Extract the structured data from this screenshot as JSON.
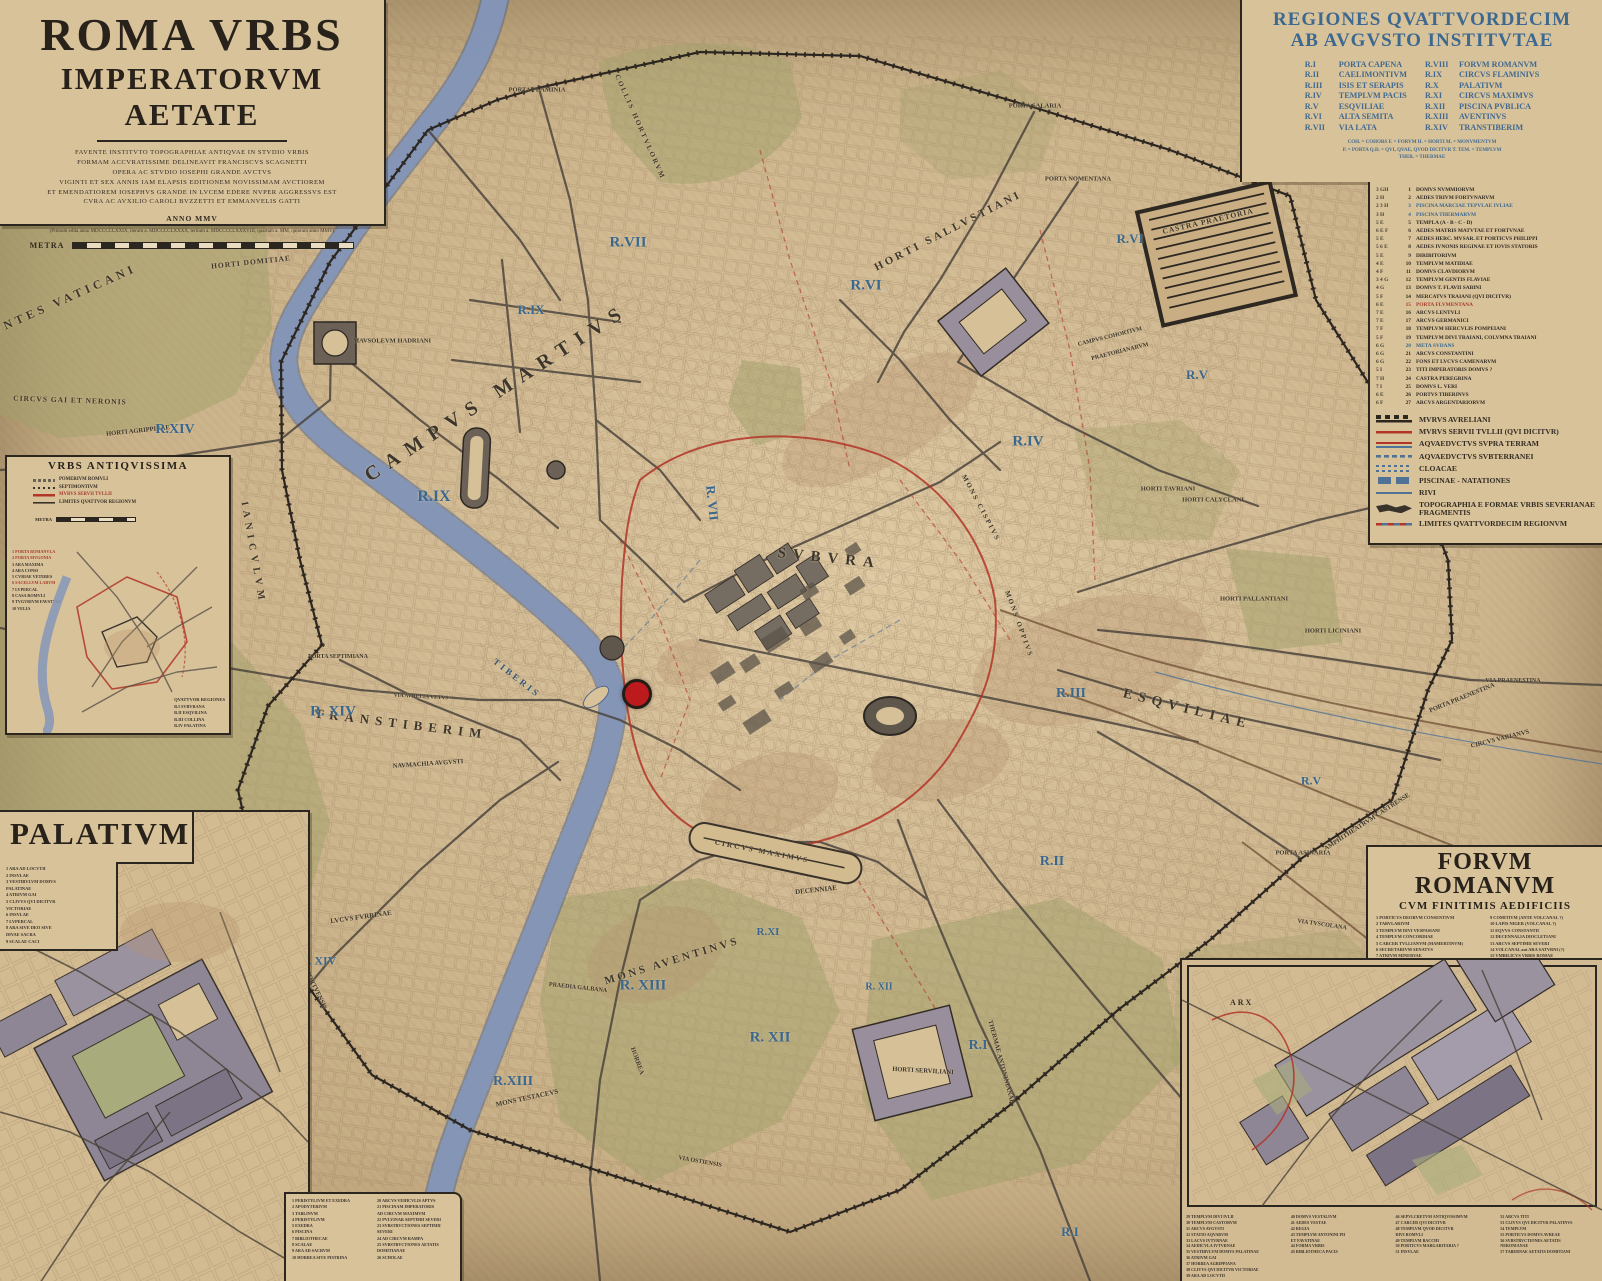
{
  "colors": {
    "parchment": "#d4bc93",
    "river": "#8496b8",
    "wall": "#2c2620",
    "servian_wall": "#b23527",
    "region_label_blue": "#3a678f",
    "legend_blue": "#416990",
    "green": "#a2a06a",
    "road": "#48413a",
    "aqueduct_brown": "#7a5b3f",
    "water_line": "#4f7296",
    "marker_red": "#bd1a1d"
  },
  "title_box": {
    "title1": "ROMA VRBS",
    "title2": "IMPERATORVM AETATE",
    "credits": [
      "FAVENTE INSTITVTO TOPOGRAPHIAE ANTIQVAE IN STVDIO VRBIS",
      "FORMAM ACCVRATISSIME DELINEAVIT FRANCISCVS SCAGNETTI",
      "OPERA AC STVDIO IOSEPHI GRANDE AVCTVS",
      "VIGINTI ET SEX ANNIS IAM ELAPSIS EDITIONEM NOVISSIMAM AVCTIOREM",
      "ET EMENDATIOREM IOSEPHVS GRANDE IN LVCEM EDERE NVPER AGGRESSVS EST",
      "CVRA AC AVXILIO CAROLI BVZZETTI ET EMMANVELIS GATTI"
    ],
    "anno": "ANNO MMV",
    "editions": "(Primum edita anno MDCCCCLXXIX, iterum a. MDCCCCLXXXX, tertium a. MDCCCCLXXXVIII, quartum a. MM, quintum anno MMV)",
    "scale_label": "METRA"
  },
  "regiones": {
    "title1": "REGIONES QVATTVORDECIM",
    "title2": "AB AVGVSTO INSTITVTAE",
    "left": [
      {
        "code": "R.I",
        "name": "PORTA CAPENA"
      },
      {
        "code": "R.II",
        "name": "CAELIMONTIVM"
      },
      {
        "code": "R.III",
        "name": "ISIS ET SERAPIS"
      },
      {
        "code": "R.IV",
        "name": "TEMPLVM PACIS"
      },
      {
        "code": "R.V",
        "name": "ESQVILIAE"
      },
      {
        "code": "R.VI",
        "name": "ALTA SEMITA"
      },
      {
        "code": "R.VII",
        "name": "VIA LATA"
      }
    ],
    "right": [
      {
        "code": "R.VIII",
        "name": "FORVM ROMANVM"
      },
      {
        "code": "R.IX",
        "name": "CIRCVS FLAMINIVS"
      },
      {
        "code": "R.X",
        "name": "PALATIVM"
      },
      {
        "code": "R.XI",
        "name": "CIRCVS MAXIMVS"
      },
      {
        "code": "R.XII",
        "name": "PISCINA PVBLICA"
      },
      {
        "code": "R.XIII",
        "name": "AVENTINVS"
      },
      {
        "code": "R.XIV",
        "name": "TRANSTIBERIM"
      }
    ],
    "abbreviations": [
      "COH. = COHORS      F. = FORVM      H. = HORTI      M. = MONVMENTVM",
      "P. = PORTA      Q.D. = QVI, QVAE, QVOD DICITVR      T. TEM. = TEMPLVM",
      "THER. = THERMAE"
    ]
  },
  "index": {
    "entries": [
      {
        "g": "3 GH",
        "n": "1",
        "t": "DOMVS NVMMIORVM"
      },
      {
        "g": "2 H",
        "n": "2",
        "t": "AEDES TRIVM FORTVNARVM"
      },
      {
        "g": "2 3 H",
        "n": "3",
        "t": "PISCINA MARCIAE TEPVLAE IVLIAE",
        "c": "blue"
      },
      {
        "g": "3 H",
        "n": "4",
        "t": "PISCINA THERMARVM",
        "c": "blue"
      },
      {
        "g": "5 E",
        "n": "5",
        "t": "TEMPLA  (A - B - C - D)"
      },
      {
        "g": "6 E F",
        "n": "6",
        "t": "AEDES MATRIS MATVTAE ET FORTVNAE"
      },
      {
        "g": "5 E",
        "n": "7",
        "t": "AEDES HERC. MVSAR. ET PORTICVS PHILIPPI"
      },
      {
        "g": "5 6 E",
        "n": "8",
        "t": "AEDES IVNONIS REGINAE ET IOVIS STATORIS"
      },
      {
        "g": "5 E",
        "n": "9",
        "t": "DIRIBITORIVM"
      },
      {
        "g": "4 E",
        "n": "10",
        "t": "TEMPLVM MATIDIAE"
      },
      {
        "g": "4 F",
        "n": "11",
        "t": "DOMVS CLAVDIORVM"
      },
      {
        "g": "3 4 G",
        "n": "12",
        "t": "TEMPLVM GENTIS FLAVIAE"
      },
      {
        "g": "4 G",
        "n": "13",
        "t": "DOMVS T. FLAVII SABINI"
      },
      {
        "g": "5 F",
        "n": "14",
        "t": "MERCATVS TRAIANI (QVI DICITVR)"
      },
      {
        "g": "6 E",
        "n": "15",
        "t": "PORTA FLVMENTANA",
        "c": "red"
      },
      {
        "g": "7 E",
        "n": "16",
        "t": "ARCVS LENTVLI"
      },
      {
        "g": "7 E",
        "n": "17",
        "t": "ARCVS GERMANICI"
      },
      {
        "g": "7 F",
        "n": "18",
        "t": "TEMPLVM HERCVLIS POMPEIANI"
      },
      {
        "g": "5 F",
        "n": "19",
        "t": "TEMPLVM DIVI TRAIANI, COLVMNA TRAIANI"
      },
      {
        "g": "6 G",
        "n": "20",
        "t": "META SVDANS",
        "c": "blue"
      },
      {
        "g": "6 G",
        "n": "21",
        "t": "ARCVS CONSTANTINI"
      },
      {
        "g": "6 G",
        "n": "22",
        "t": "FONS ET LVCVS CAMENARVM"
      },
      {
        "g": "5 I",
        "n": "23",
        "t": "TITI IMPERATORIS DOMVS ?"
      },
      {
        "g": "7 H",
        "n": "24",
        "t": "CASTRA PEREGRINA"
      },
      {
        "g": "7 I",
        "n": "25",
        "t": "DOMVS L. VERI"
      },
      {
        "g": "6 E",
        "n": "26",
        "t": "PORTVS TIBERINVS"
      },
      {
        "g": "6 F",
        "n": "27",
        "t": "ARCVS ARGENTARIORVM"
      }
    ]
  },
  "symbols": {
    "items": [
      {
        "k": "wall",
        "t": "MVRVS AVRELIANI"
      },
      {
        "k": "servian",
        "t": "MVRVS SERVII TVLLII (QVI DICITVR)"
      },
      {
        "k": "aq-supra",
        "t": "AQVAEDVCTVS SVPRA TERRAM"
      },
      {
        "k": "aq-sub",
        "t": "AQVAEDVCTVS SVBTERRANEI"
      },
      {
        "k": "cloacae",
        "t": "CLOACAE"
      },
      {
        "k": "piscinae",
        "t": "PISCINAE - NATATIONES"
      },
      {
        "k": "rivi",
        "t": "RIVI"
      },
      {
        "k": "frag",
        "t": "TOPOGRAPHIA E FORMAE VRBIS SEVERIANAE FRAGMENTIS"
      },
      {
        "k": "limites",
        "t": "LIMITES QVATTVORDECIM REGIONVM"
      }
    ]
  },
  "urbs_inset": {
    "title": "VRBS ANTIQVISSIMA",
    "legend": [
      {
        "k": "pomerium",
        "t": "POMERIVM ROMVLI"
      },
      {
        "k": "septimontium",
        "t": "SEPTIMONTIVM"
      },
      {
        "k": "servian",
        "t": "MVRVS SERVII TVLLII",
        "c": "red"
      },
      {
        "k": "limites4",
        "t": "LIMITES QVATTVOR REGIONVM"
      }
    ],
    "scale_label": "METRA",
    "sites": [
      "PORTA ROMANVLA",
      "PORTA MVGONIA",
      "ARA MAXIMA",
      "ARA CONSI",
      "CVRIAE VETERES",
      "SACELLVM LARVM",
      "LVPERCAL",
      "CASA ROMVLI",
      "TVGVRIVM FAVSTVLI",
      "VELIA"
    ],
    "sites_red": [
      0,
      1,
      5
    ],
    "regions_title": "QVATTVOR REGIONES",
    "regions": [
      "R.I   SVBVRANA",
      "R.II  ESQVILINA",
      "R.III COLLINA",
      "R.IV  PALATINA"
    ]
  },
  "palatium_inset": {
    "title": "PALATIVM",
    "list": [
      "1  ARA AD LOCVTII",
      "2  INSVLAE",
      "3  VESTIBVLVM DOMVS",
      "    PALATINAE",
      "4  ATRIVM GAI",
      "5  CLIVVS QVI DICITVR",
      "    VICTORIAE",
      "6  INSVLAE",
      "7  LVPERCAL",
      "8  ARA SIVE DEO SIVE",
      "    DIVAE SACRA",
      "9  SCALAE CACI"
    ]
  },
  "south_list": {
    "left": [
      "1  PERISTYLIVM ET EXEDRA",
      "2  APODYTERIVM",
      "3  TABLINVM",
      "4  PERISTYLIVM",
      "5  EXEDRA",
      "6  PISCINA",
      "7  BIBLIOTHECAE",
      "8  SCALAE",
      "9  ARA AD SACRVM",
      "10 HORREA SIVE PISTRINA"
    ],
    "right": [
      "20 ARCVS VEHICVLIS APTVS",
      "21 PISCINAM IMPERATORIS",
      "     AD CIRCVM MAXIMVM",
      "22 PVLVINAR SEPTIMII SEVERI",
      "23 SVBSTRVCTIONES SEPTIMII",
      "     SEVERI",
      "24 AD CIRCVM RAMPA",
      "25 SVBSTRVCTIONES AETATIS",
      "     DOMITIANAE",
      "26 SCHOLAE"
    ]
  },
  "forum_inset": {
    "title": "FORVM ROMANVM",
    "subtitle": "CVM FINITIMIS AEDIFICIIS",
    "map_label": "ARX",
    "col1": [
      "1  PORTICVS DEORVM CONSENTIVM",
      "2  TABVLARIVM",
      "3  TEMPLVM DIVI VESPASIANI",
      "4  TEMPLVM CONCORDIAE",
      "5  CARCER TVLLIANVM (MAMERTINVM)",
      "6  SECRETARIVM SENATVS",
      "7  ATRIVM MINERVAE",
      "8  CVRIA"
    ],
    "col2": [
      "9  COMITIVM (ANTE VOLCANAL ?)",
      "10 LAPIS NIGER (VOLCANAL ?)",
      "11 EQVVS CONSTANTII",
      "12 DECENNALIA DIOCLETIANI",
      "13 ARCVS SEPTIMII SEVERI",
      "14 VOLCANAL aut ARA SATVRNI (?)",
      "15 VMBILICVS VRBIS ROMAE",
      "16 ROSTRA",
      "17 MILIARIVM AVREVM",
      "18 ARCVS",
      "19 AEDES SATVRNI"
    ],
    "bottom1": [
      "29 TEMPLVM DIVI IVLII",
      "30 TEMPLVM CASTORVM",
      "31 ARCVS AVGVSTI",
      "32 STATIO AQVARVM",
      "33 LACVS IVTVRNAE",
      "34 AEDICVLA IVTVRNAE",
      "35 VESTIBVLVM DOMVS PALATINAE",
      "36 ATRIVM GAI",
      "37 HORREA AGRIPPIANA",
      "38 CLIVVS QVI DICITVR VICTORIAE",
      "39 ARA AD LOCVTII"
    ],
    "bottom2": [
      "40 DOMVS VESTALIVM",
      "41 AEDES VESTAE",
      "42 REGIA",
      "43 TEMPLVM ANTONINI PII",
      "     ET FAVSTINAE",
      "44 FORMA VRBIS",
      "45 BIBLIOTHECA PACIS"
    ],
    "bottom3": [
      "46 SEPVLCRETVM ANTIQVISSIMVM",
      "47 CARCER QVI DICITVR",
      "48 TEMPLVM QVOD DICITVR",
      "     DIVI ROMVLI",
      "49 TEMPLVM BACCHI",
      "50 PORTICVS MARGARITARIA ?",
      "51 INSVLAE"
    ],
    "bottom4": [
      "52 ARCVS TITI",
      "53 CLIVVS QVI DICITVR PALATINVS",
      "54 TEMPLVM",
      "55 PORTICVS DOMVS AVREAE",
      "56 SVBSTRVCTIONES AETATIS",
      "     NERONIANAE",
      "57 TABERNAE AETATIS DOMITIANI"
    ]
  },
  "map_labels": [
    {
      "t": "MONTES VATICANI",
      "x": 57,
      "y": 303,
      "s": 12,
      "r": -24,
      "ls": 4
    },
    {
      "t": "HORTI DOMITIAE",
      "x": 251,
      "y": 262,
      "s": 7.5,
      "r": -6,
      "ls": 1
    },
    {
      "t": "MAVSOLEVM HADRIANI",
      "x": 392,
      "y": 341,
      "s": 6.5
    },
    {
      "t": "CIRCVS GAI ET NERONIS",
      "x": 70,
      "y": 400,
      "s": 7.5,
      "r": 2,
      "ls": 1
    },
    {
      "t": "HORTI AGRIPPINAE",
      "x": 138,
      "y": 431,
      "s": 6.5,
      "r": -6
    },
    {
      "t": "CAMPVS MARTIVS",
      "x": 497,
      "y": 393,
      "s": 20,
      "r": -33,
      "ls": 9
    },
    {
      "t": "R.VII",
      "x": 628,
      "y": 243,
      "s": 15,
      "c": "blue"
    },
    {
      "t": "R.IX",
      "x": 531,
      "y": 310,
      "s": 13,
      "c": "blue"
    },
    {
      "t": "R.IX",
      "x": 434,
      "y": 497,
      "s": 16,
      "c": "blue"
    },
    {
      "t": "R. VII",
      "x": 712,
      "y": 503,
      "s": 13,
      "r": 84,
      "c": "blue"
    },
    {
      "t": "COLLIS HORTVLORVM",
      "x": 640,
      "y": 127,
      "s": 7,
      "r": 66,
      "ls": 2
    },
    {
      "t": "PORTA FLAMINIA",
      "x": 537,
      "y": 90,
      "s": 6.5
    },
    {
      "t": "PORTA SALARIA",
      "x": 1035,
      "y": 106,
      "s": 6.5
    },
    {
      "t": "PORTA NOMENTANA",
      "x": 1078,
      "y": 179,
      "s": 6.5
    },
    {
      "t": "HORTI SALLVSTIANI",
      "x": 948,
      "y": 231,
      "s": 11,
      "r": -27,
      "ls": 3
    },
    {
      "t": "R.VI",
      "x": 866,
      "y": 286,
      "s": 15,
      "c": "blue"
    },
    {
      "t": "R.VI",
      "x": 1130,
      "y": 239,
      "s": 13,
      "c": "blue"
    },
    {
      "t": "CASTRA PRAETORIA",
      "x": 1208,
      "y": 221,
      "s": 7.5,
      "r": -13,
      "ls": 1
    },
    {
      "t": "CAMPVS COHORTIVM",
      "x": 1110,
      "y": 337,
      "s": 6,
      "r": -14
    },
    {
      "t": "PRAETORIANARVM",
      "x": 1120,
      "y": 352,
      "s": 6,
      "r": -14
    },
    {
      "t": "R.IV",
      "x": 1028,
      "y": 442,
      "s": 15,
      "c": "blue"
    },
    {
      "t": "R.V",
      "x": 1197,
      "y": 375,
      "s": 13,
      "c": "blue"
    },
    {
      "t": "R.V",
      "x": 1311,
      "y": 781,
      "s": 12,
      "c": "blue"
    },
    {
      "t": "HORTI TAVRIANI",
      "x": 1168,
      "y": 489,
      "s": 6.5
    },
    {
      "t": "HORTI CALYCLANI",
      "x": 1213,
      "y": 500,
      "s": 6.5
    },
    {
      "t": "HORTI PALLANTIANI",
      "x": 1254,
      "y": 599,
      "s": 6.5
    },
    {
      "t": "HORTI LICINIANI",
      "x": 1333,
      "y": 631,
      "s": 6.5
    },
    {
      "t": "SVBVRA",
      "x": 829,
      "y": 559,
      "s": 15,
      "r": 6,
      "ls": 7
    },
    {
      "t": "MONS CISPIVS",
      "x": 981,
      "y": 508,
      "s": 7,
      "r": 62,
      "ls": 2
    },
    {
      "t": "MONS OPPIVS",
      "x": 1019,
      "y": 624,
      "s": 7,
      "r": 70,
      "ls": 2
    },
    {
      "t": "R.III",
      "x": 1071,
      "y": 694,
      "s": 14,
      "c": "blue"
    },
    {
      "t": "ESQVILIAE",
      "x": 1187,
      "y": 710,
      "s": 14,
      "r": 14,
      "ls": 6
    },
    {
      "t": "PORTA PRAENESTINA",
      "x": 1462,
      "y": 698,
      "s": 6.5,
      "r": -22
    },
    {
      "t": "VIA PRAENESTINA",
      "x": 1513,
      "y": 681,
      "s": 6
    },
    {
      "t": "CIRCVS VARIANVS",
      "x": 1500,
      "y": 739,
      "s": 6.5,
      "r": -14
    },
    {
      "t": "AMPHITHEATRVM CASTRENSE",
      "x": 1367,
      "y": 822,
      "s": 6.5,
      "r": -33
    },
    {
      "t": "PORTA ASINARIA",
      "x": 1303,
      "y": 853,
      "s": 6.5
    },
    {
      "t": "VIA TVSCOLANA",
      "x": 1322,
      "y": 925,
      "s": 6,
      "r": 8
    },
    {
      "t": "R.II",
      "x": 1052,
      "y": 862,
      "s": 14,
      "c": "blue"
    },
    {
      "t": "R.I",
      "x": 978,
      "y": 1046,
      "s": 14,
      "c": "blue"
    },
    {
      "t": "R.I",
      "x": 1070,
      "y": 1232,
      "s": 13,
      "c": "blue"
    },
    {
      "t": "HORTI SERVILIANI",
      "x": 923,
      "y": 1071,
      "s": 6.5,
      "r": 3
    },
    {
      "t": "DECENNIAE",
      "x": 816,
      "y": 890,
      "s": 7,
      "r": -6
    },
    {
      "t": "R.XI",
      "x": 768,
      "y": 932,
      "s": 11,
      "c": "blue"
    },
    {
      "t": "R. XII",
      "x": 770,
      "y": 1038,
      "s": 15,
      "c": "blue"
    },
    {
      "t": "R. XII",
      "x": 879,
      "y": 987,
      "s": 10,
      "c": "blue"
    },
    {
      "t": "MONS AVENTINVS",
      "x": 672,
      "y": 961,
      "s": 11,
      "r": -17,
      "ls": 3
    },
    {
      "t": "R. XIII",
      "x": 643,
      "y": 986,
      "s": 15,
      "c": "blue"
    },
    {
      "t": "R.XIII",
      "x": 513,
      "y": 1082,
      "s": 14,
      "c": "blue"
    },
    {
      "t": "MONS TESTACEVS",
      "x": 527,
      "y": 1098,
      "s": 7,
      "r": -12
    },
    {
      "t": "HORREA",
      "x": 637,
      "y": 1061,
      "s": 6.5,
      "r": 70
    },
    {
      "t": "PRAEDIA GALBANA",
      "x": 578,
      "y": 988,
      "s": 6,
      "r": 6
    },
    {
      "t": "THERMAE ANTONINIANAE",
      "x": 1001,
      "y": 1062,
      "s": 6.5,
      "r": 75
    },
    {
      "t": "CIRCVS MAXIMVS",
      "x": 762,
      "y": 851,
      "s": 7.5,
      "r": 11,
      "ls": 2
    },
    {
      "t": "VIA OSTIENSIS",
      "x": 700,
      "y": 1162,
      "s": 6,
      "r": 10
    },
    {
      "t": "PORTA PORTVENSIS",
      "x": 311,
      "y": 980,
      "s": 6.5,
      "r": 64
    },
    {
      "t": "LVCVS FVRRINAE",
      "x": 361,
      "y": 917,
      "s": 7,
      "r": -8
    },
    {
      "t": "IANICVLVM",
      "x": 253,
      "y": 553,
      "s": 10,
      "r": 80,
      "ls": 5
    },
    {
      "t": "TRANSTIBERIM",
      "x": 401,
      "y": 724,
      "s": 13,
      "r": 7,
      "ls": 6
    },
    {
      "t": "R. XIV",
      "x": 333,
      "y": 712,
      "s": 15,
      "c": "blue"
    },
    {
      "t": "R.XIV",
      "x": 175,
      "y": 430,
      "s": 14,
      "c": "blue"
    },
    {
      "t": "R. XIV",
      "x": 318,
      "y": 961,
      "s": 12,
      "c": "blue"
    },
    {
      "t": "TIBERIS",
      "x": 517,
      "y": 678,
      "s": 9,
      "r": 38,
      "ls": 3,
      "c": "dblue"
    },
    {
      "t": "VIA AVRELIA VETVS",
      "x": 421,
      "y": 697,
      "s": 5.5,
      "r": 3
    },
    {
      "t": "NAVMACHIA AVGVSTI",
      "x": 428,
      "y": 764,
      "s": 6.5,
      "r": -4
    },
    {
      "t": "PORTA SEPTIMIANA",
      "x": 338,
      "y": 657,
      "s": 6
    }
  ],
  "marker": {
    "x": 637,
    "y": 694,
    "r": 15
  }
}
